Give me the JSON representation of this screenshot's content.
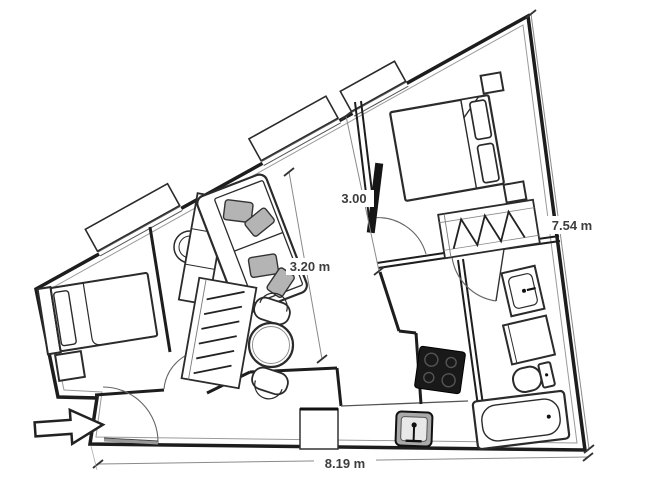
{
  "plan": {
    "background": "#ffffff",
    "wall_color": "#1d1d1d",
    "dimension_text_color": "#3d3d3d",
    "labels": {
      "right": "7.54 m",
      "bottom": "8.19 m",
      "living_width": "3.20 m",
      "bedroom_width": "3.00"
    },
    "icons": {
      "entrance": "entrance-arrow"
    },
    "furniture": [
      "double-bed",
      "nightstand",
      "wardrobe",
      "single-bed",
      "sofa",
      "cushion",
      "sideboard",
      "wall-lamp",
      "dining-table",
      "chair",
      "tv-panel",
      "washbasin",
      "washing-machine",
      "toilet",
      "bathtub",
      "kitchen-sink",
      "stove",
      "cabinet",
      "entrance-door"
    ]
  }
}
